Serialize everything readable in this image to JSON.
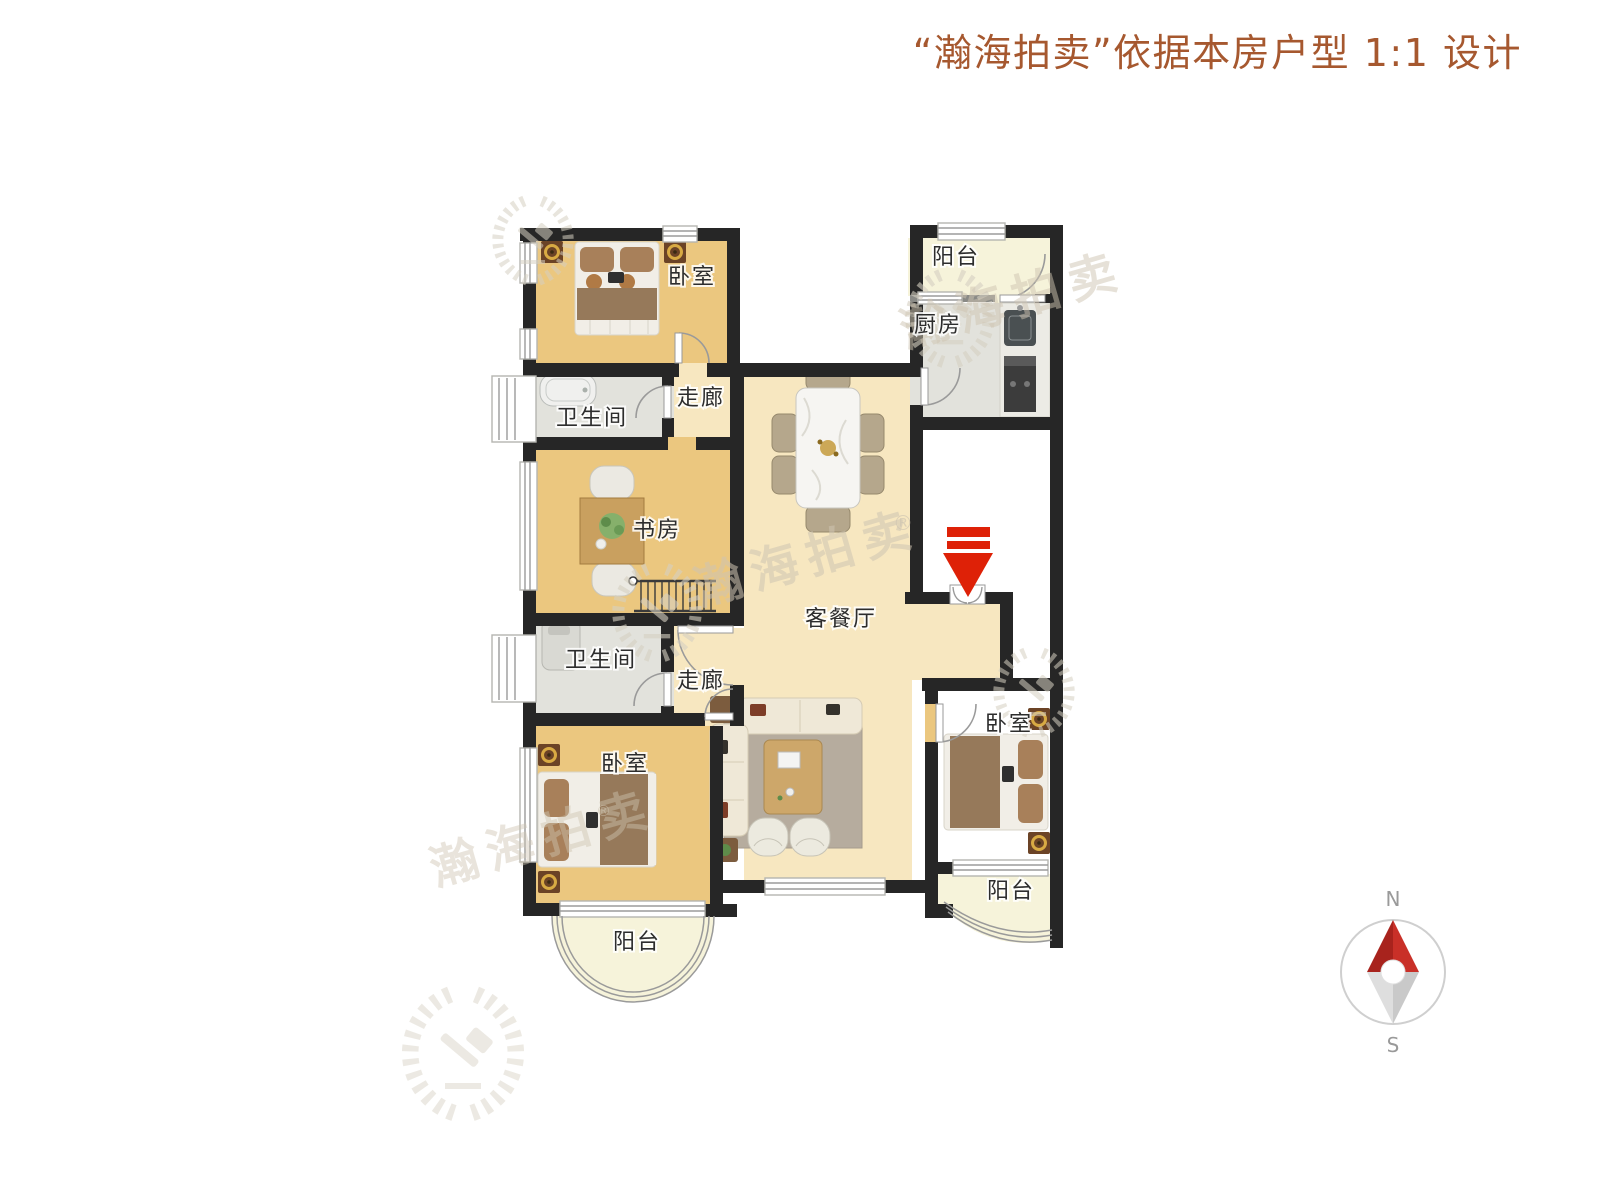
{
  "title": {
    "text": "“瀚海拍卖”依据本房户型 1:1 设计"
  },
  "watermark": {
    "brand": "瀚海拍卖",
    "registered": "®"
  },
  "rooms": {
    "bedroom_top": "卧室",
    "bedroom_bottom": "卧室",
    "bedroom_right": "卧室",
    "balcony_top": "阳台",
    "balcony_bottom_left": "阳台",
    "balcony_bottom_right": "阳台",
    "kitchen": "厨房",
    "bathroom_top": "卫生间",
    "bathroom_bottom": "卫生间",
    "corridor_top": "走廊",
    "corridor_bottom": "走廊",
    "study": "书房",
    "living_dining": "客餐厅"
  },
  "compass": {
    "north": "N",
    "south": "S"
  },
  "colors": {
    "title": "#a6582f",
    "wall": "#262626",
    "wood_floor": "#ebc77f",
    "cream_floor": "#f7e7c0",
    "tile_floor": "#e2e2dc",
    "balcony_floor": "#f6f3da",
    "arrow_red": "#de2107",
    "label": "#2d2d2d",
    "watermark": "#cfc5b2"
  }
}
